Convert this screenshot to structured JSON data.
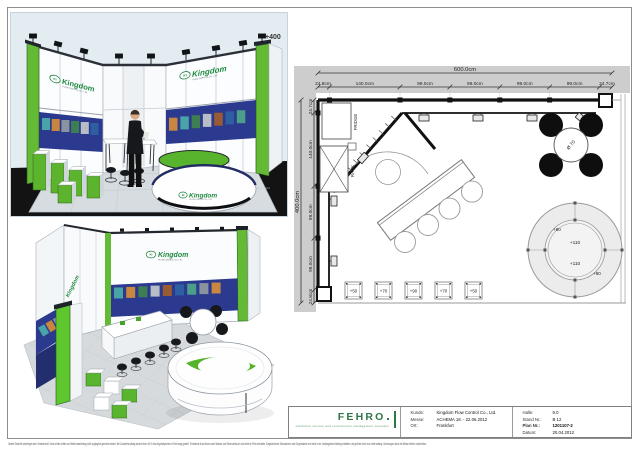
{
  "sheet": {
    "elevation_label": "+400"
  },
  "brand": {
    "abbr": "KI",
    "name": "Kingdom",
    "subtitle": "FLOW CONTROL CO., LTD."
  },
  "floor_plan": {
    "total_width": "600.0cm",
    "total_height": "400.0cm",
    "top_segments": [
      "24.8cm",
      "140.0cm",
      "99.0cm",
      "99.0cm",
      "99.0cm",
      "99.0cm",
      "24.7cm"
    ],
    "left_segments": [
      "24.7cm",
      "140.0cm",
      "99.0cm",
      "99.0cm",
      "24.8cm"
    ],
    "fridge": "FRIDGE",
    "rack": "RACK",
    "table_diameter": "Ø 70",
    "counter_heights": [
      "+80",
      "+110",
      "+110",
      "+80"
    ],
    "podium_heights": [
      "+50",
      "+70",
      "+90",
      "+70",
      "+50"
    ]
  },
  "title_block": {
    "company": "FEHRO",
    "tagline": "exhibition service and construction management company",
    "rows_left": [
      {
        "label": "Kunde:",
        "value": "Kingdom Flow Control Co., Ltd."
      },
      {
        "label": "Messe:",
        "value": "ACHEMA 18. - 22.06.2012"
      },
      {
        "label": "Ort:",
        "value": "Frankfurt"
      }
    ],
    "rows_right": [
      {
        "label": "Halle:",
        "value": "9.0"
      },
      {
        "label": "Stand Nr.:",
        "value": "B 12"
      },
      {
        "label": "Plan Nr.:",
        "value": "1201107-2"
      },
      {
        "label": "Datum:",
        "value": "20.04.2012"
      }
    ]
  },
  "disclaimer": "Unsere Entwürfe unterliegen dem Urheberrecht. Diese dürfen dritten zur Weiterverarbeitung nicht zugänglich gemacht werden. Bei Zuwiderhandlung werden Ihnen 40 % des Angebotspreises in Rechnung gestellt. Technische Anschlüsse sowie Wasser und Stromverbrauch sind nicht im Preis enthalten. Eingezeichnete Dekorationen und Gegenstände sind nicht in der Leistungsbeschreibung enthalten und gehören nicht zum Lieferumfang. Änderungen durch die Messe bleiben vorbehalten."
}
